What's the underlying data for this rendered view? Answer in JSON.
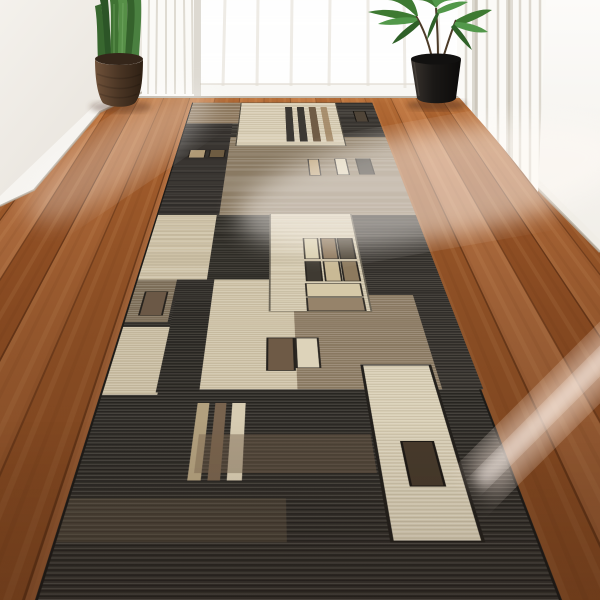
{
  "scene": {
    "description": "Interior photo: long geometric runner rug on warm hardwood hallway floor, white walls, sheer white curtains with bright window light, two potted plants",
    "objects": [
      "hardwood-floor",
      "runner-rug",
      "left-snake-plant",
      "right-palm-plant",
      "white-curtains",
      "window-light",
      "baseboard",
      "sun-beam"
    ]
  },
  "palette": {
    "wall": "#f3f0eb",
    "wall_right": "#fbfaf7",
    "baseboard": "#f8f7f4",
    "baseboard_shadow": "#b5ad9f",
    "curtain": "#fbfaf7",
    "curtain_fold": "#c9c2b4",
    "window_glow": "#ffffff",
    "floor_light": "#b57040",
    "floor_mid": "#a05b2b",
    "floor_dark": "#6f3b1a",
    "sun_beam": "#ffeee2",
    "sheen": "#fffaf5",
    "pot_left_dark": "#35261a",
    "pot_left_light": "#6b4e35",
    "pot_right": "#121110",
    "leaf_dark": "#2c5527",
    "leaf_mid": "#407333",
    "leaf_light": "#568f47",
    "shadow": "#46281633"
  },
  "rug": {
    "base": "#34312c",
    "panels": [
      {
        "name": "tan-corner",
        "color": "#8f7a60"
      },
      {
        "name": "cream-striped-panel",
        "color": "#d8cdb4",
        "stripes": [
          "#3c3833",
          "#3c3833",
          "#705c46",
          "#9c7f5c"
        ]
      },
      {
        "name": "far-right-charcoal",
        "color": "#3e3a35"
      },
      {
        "name": "left-charcoal-band",
        "color": "#393531"
      },
      {
        "name": "taupe-band",
        "color": "#8a7a63"
      },
      {
        "name": "left-beige-panel",
        "color": "#cdc1a6"
      },
      {
        "name": "center-charcoal-panel",
        "color": "#36332d"
      },
      {
        "name": "grid-panel",
        "color": "#d3c8ae"
      },
      {
        "name": "right-charcoal-band",
        "color": "#3a3631"
      },
      {
        "name": "left-taupe-block",
        "color": "#7d6e59"
      },
      {
        "name": "center-beige-panel",
        "color": "#cfc3a8"
      },
      {
        "name": "right-taupe-panel",
        "color": "#8c7b64"
      },
      {
        "name": "cream-vertical-panel",
        "color": "#d8ceb5"
      }
    ],
    "grid_squares": [
      "#d9cfae",
      "#8a7458",
      "#4f4638",
      "#3f3a32",
      "#c9b995",
      "#8d7a5e"
    ],
    "bars": [
      "#d6c9a8",
      "#96836a"
    ],
    "accent_squares": [
      "#b09a76",
      "#6e5c42",
      "#bda47c",
      "#dcd1b6",
      "#322f29",
      "#6b5846",
      "#6e5a46",
      "#ddd3ba",
      "#473a2c",
      "#504538"
    ],
    "vertical_stripes": [
      "#b2a07e",
      "#78634e",
      "#d7ccb2"
    ]
  }
}
